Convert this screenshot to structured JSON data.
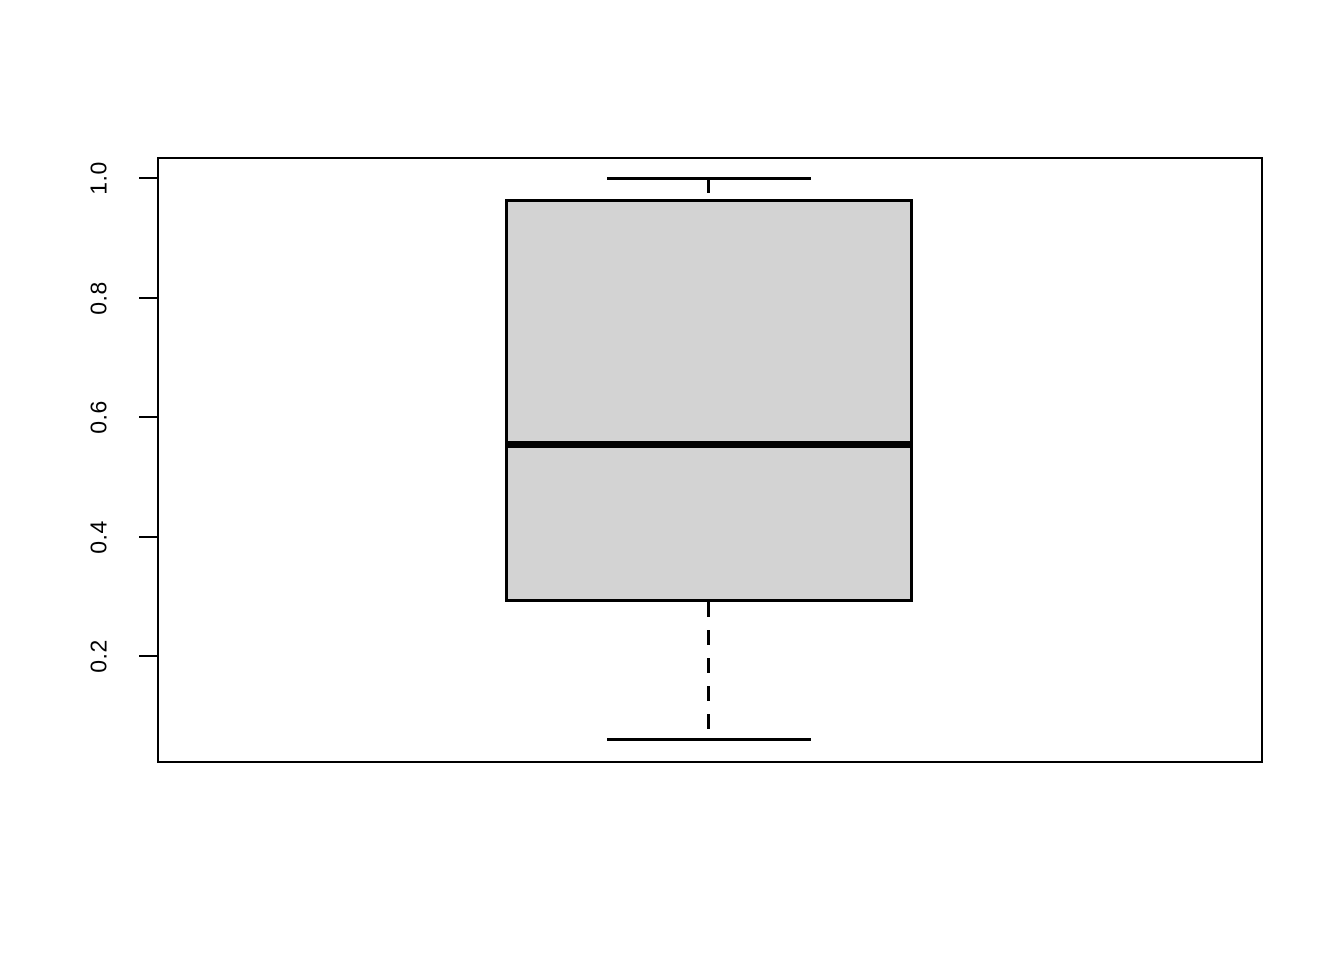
{
  "figure": {
    "background": "#ffffff"
  },
  "chart_data": {
    "type": "boxplot",
    "orientation": "vertical",
    "title": "",
    "xlabel": "",
    "ylabel": "",
    "categories": [
      ""
    ],
    "series": [
      {
        "name": "",
        "min": 0.06,
        "q1": 0.29,
        "median": 0.555,
        "q3": 0.965,
        "max": 1.0,
        "outliers": []
      }
    ],
    "yticks": [
      0.2,
      0.4,
      0.6,
      0.8,
      1.0
    ],
    "ytick_labels": [
      "0.2",
      "0.4",
      "0.6",
      "0.8",
      "1.0"
    ],
    "ylim": [
      0.021,
      1.036
    ],
    "grid": false,
    "legend": false,
    "box_fill": "#d3d3d3",
    "line_color": "#000000",
    "whisker_style": "dashed"
  }
}
